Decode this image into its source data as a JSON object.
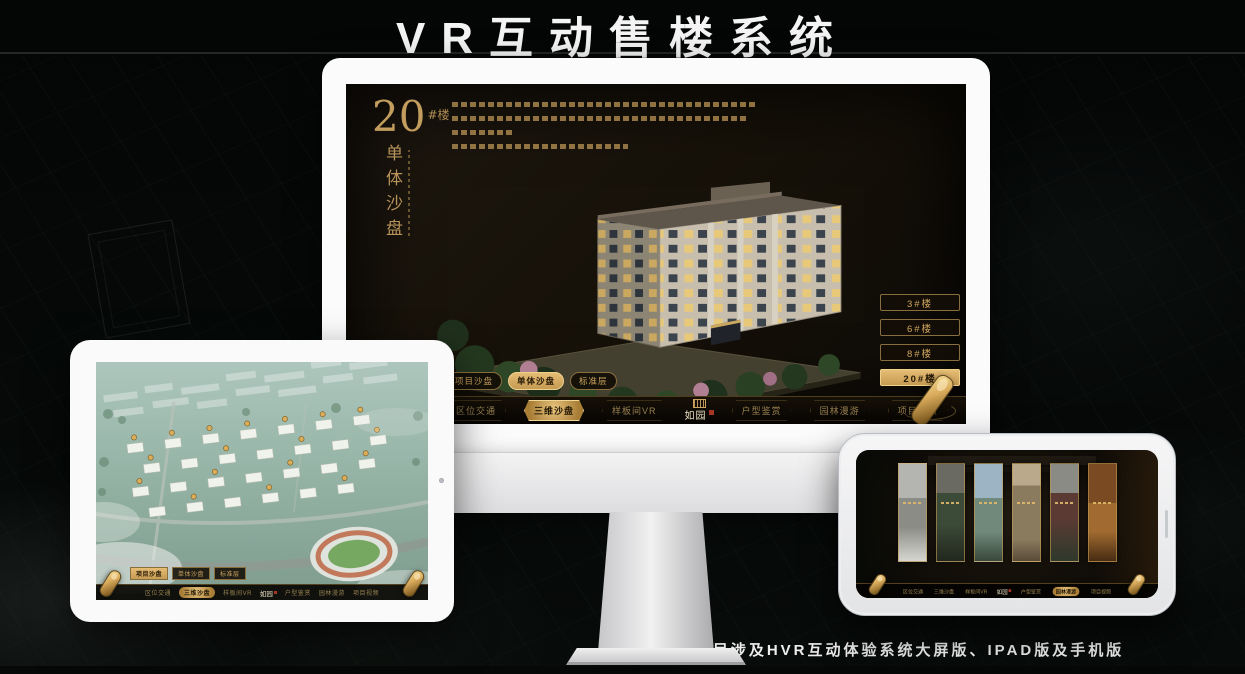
{
  "page": {
    "title": "VR互动售楼系统",
    "footnote": "*本项目涉及HVR互动体验系统大屏版、IPAD版及手机版"
  },
  "colors": {
    "gold": "#c9a25f",
    "gold_bright": "#e3ba71",
    "seal_red": "#a63524",
    "nav_bg": "#0b0805",
    "monitor_screen_bg": "#171209"
  },
  "monitor": {
    "heading_number": "20",
    "heading_suffix": "#楼",
    "heading_subtitle": "单体沙盘",
    "building_buttons": [
      {
        "label": "3#楼",
        "selected": false
      },
      {
        "label": "6#楼",
        "selected": false
      },
      {
        "label": "8#楼",
        "selected": false
      },
      {
        "label": "20#楼",
        "selected": true
      }
    ],
    "subtabs": [
      {
        "label": "项目沙盘",
        "selected": false
      },
      {
        "label": "单体沙盘",
        "selected": true
      },
      {
        "label": "标准层",
        "selected": false
      }
    ],
    "nav_items": [
      {
        "label": "区位交通",
        "selected": false
      },
      {
        "label": "三维沙盘",
        "selected": true
      },
      {
        "label": "样板间VR",
        "selected": false
      },
      {
        "label": "户型鉴赏",
        "selected": false
      },
      {
        "label": "园林漫游",
        "selected": false
      },
      {
        "label": "项目视频",
        "selected": false
      }
    ],
    "logo_text": "如园"
  },
  "tablet": {
    "subtabs": [
      {
        "label": "项目沙盘",
        "selected": true
      },
      {
        "label": "单体沙盘",
        "selected": false
      },
      {
        "label": "标准层",
        "selected": false
      }
    ],
    "nav_items": [
      {
        "label": "区位交通",
        "selected": false
      },
      {
        "label": "三维沙盘",
        "selected": true
      },
      {
        "label": "样板间VR",
        "selected": false
      },
      {
        "label": "户型鉴赏",
        "selected": false
      },
      {
        "label": "园林漫游",
        "selected": false
      },
      {
        "label": "项目视频",
        "selected": false
      }
    ],
    "logo_text": "如园"
  },
  "phone": {
    "nav_items": [
      {
        "label": "区位交通",
        "selected": false
      },
      {
        "label": "三维沙盘",
        "selected": false
      },
      {
        "label": "样板间VR",
        "selected": false
      },
      {
        "label": "户型鉴赏",
        "selected": false
      },
      {
        "label": "园林漫游",
        "selected": true
      },
      {
        "label": "项目视频",
        "selected": false
      }
    ],
    "logo_text": "如园"
  }
}
